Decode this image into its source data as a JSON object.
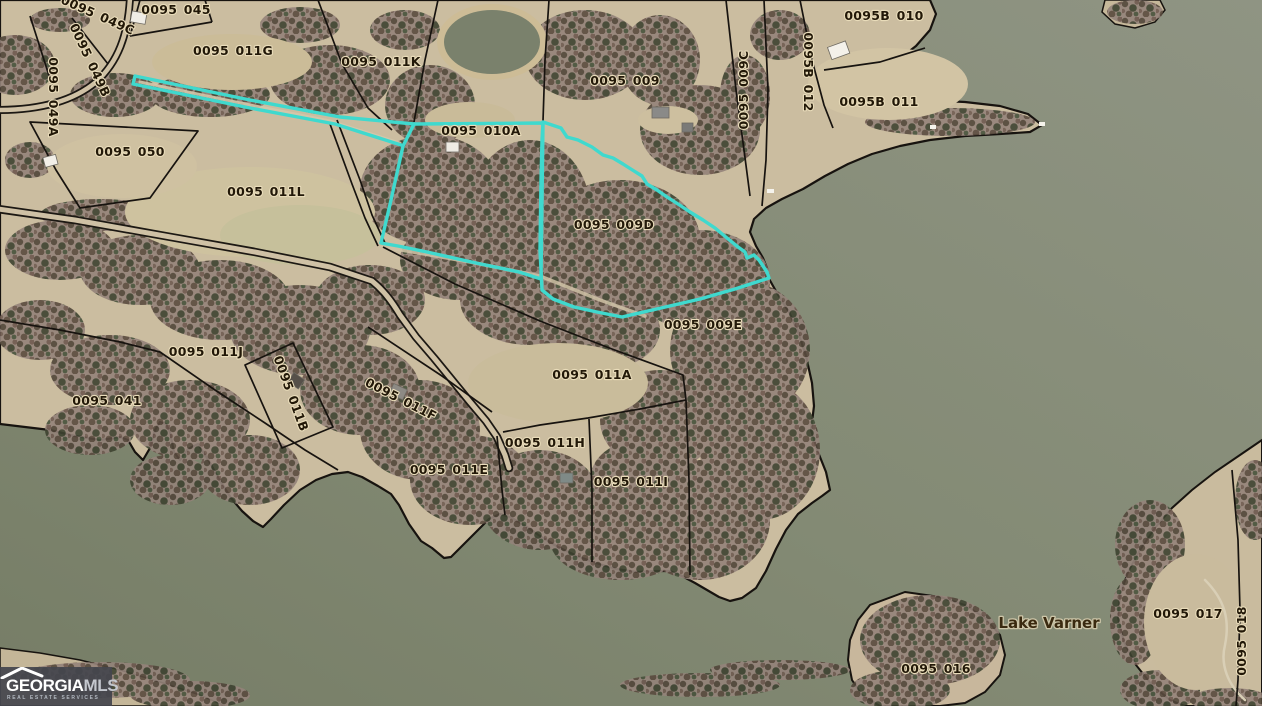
{
  "map": {
    "water_label": "Lake Varner",
    "labels": [
      {
        "text": "0095 049C",
        "x": 96,
        "y": 19,
        "rot": 24
      },
      {
        "text": "0095 045",
        "x": 176,
        "y": 14,
        "rot": 0
      },
      {
        "text": "0095 049A",
        "x": 49,
        "y": 97,
        "rot": 90
      },
      {
        "text": "0095 049B",
        "x": 86,
        "y": 62,
        "rot": 65
      },
      {
        "text": "0095 011G",
        "x": 233,
        "y": 55,
        "rot": 0
      },
      {
        "text": "0095 011K",
        "x": 381,
        "y": 66,
        "rot": 0
      },
      {
        "text": "0095 010A",
        "x": 481,
        "y": 135,
        "rot": 0
      },
      {
        "text": "0095 009",
        "x": 625,
        "y": 85,
        "rot": 0
      },
      {
        "text": "0095 009C",
        "x": 748,
        "y": 90,
        "rot": -90
      },
      {
        "text": "0095B 012",
        "x": 804,
        "y": 72,
        "rot": 90
      },
      {
        "text": "0095B 010",
        "x": 884,
        "y": 20,
        "rot": 0
      },
      {
        "text": "0095B 011",
        "x": 879,
        "y": 106,
        "rot": 0
      },
      {
        "text": "0095 050",
        "x": 130,
        "y": 156,
        "rot": 0
      },
      {
        "text": "0095 011L",
        "x": 266,
        "y": 196,
        "rot": 0
      },
      {
        "text": "0095 009D",
        "x": 614,
        "y": 229,
        "rot": 0
      },
      {
        "text": "0095 009E",
        "x": 703,
        "y": 329,
        "rot": 0
      },
      {
        "text": "0095 011J",
        "x": 206,
        "y": 356,
        "rot": 0
      },
      {
        "text": "0095 041",
        "x": 107,
        "y": 405,
        "rot": 0
      },
      {
        "text": "0095 011B",
        "x": 287,
        "y": 395,
        "rot": 70
      },
      {
        "text": "0095 011F",
        "x": 399,
        "y": 403,
        "rot": 27
      },
      {
        "text": "0095 011A",
        "x": 592,
        "y": 379,
        "rot": 0
      },
      {
        "text": "0095 011E",
        "x": 449,
        "y": 474,
        "rot": 0
      },
      {
        "text": "0095 011H",
        "x": 545,
        "y": 447,
        "rot": 0
      },
      {
        "text": "0095 011I",
        "x": 631,
        "y": 486,
        "rot": 0
      },
      {
        "text": "0095 016",
        "x": 936,
        "y": 673,
        "rot": 0
      },
      {
        "text": "0095 017",
        "x": 1188,
        "y": 618,
        "rot": 0
      },
      {
        "text": "0095 018",
        "x": 1246,
        "y": 641,
        "rot": -90
      }
    ],
    "colors": {
      "water": "#858B76",
      "land": "#CBBDA0",
      "highlight": "#3FD9CE",
      "boundary": "#17130F",
      "label": "#221808"
    }
  },
  "logo": {
    "brand_primary": "GEORGIA",
    "brand_secondary": "MLS",
    "tagline": "REAL ESTATE SERVICES"
  }
}
